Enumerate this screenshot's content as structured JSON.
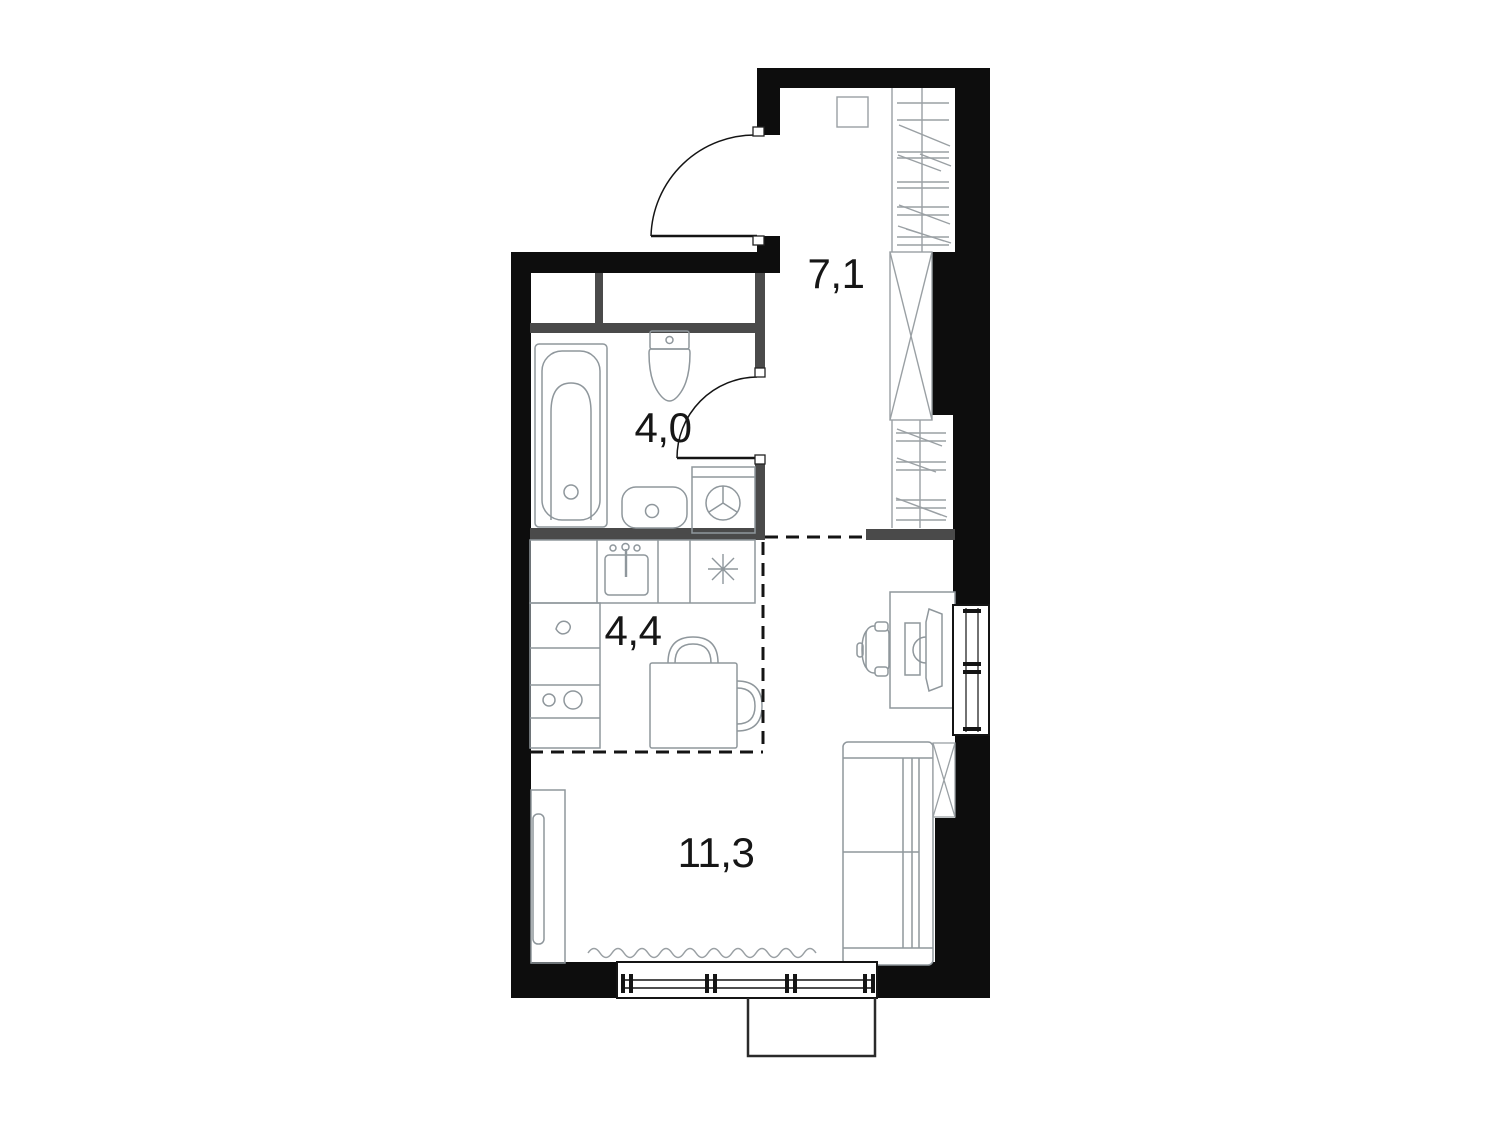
{
  "plan": {
    "type": "apartment-floor-plan",
    "rooms": {
      "hallway": {
        "area_label": "7,1"
      },
      "bathroom": {
        "area_label": "4,0"
      },
      "kitchen": {
        "area_label": "4,4"
      },
      "living_room": {
        "area_label": "11,3"
      }
    },
    "colors": {
      "exterior_wall": "#0d0d0d",
      "partition_wall": "#4a4a4a",
      "fixture_outline": "#8f979c",
      "hatch_line": "#9aa0a4",
      "window_frame": "#141414",
      "label_text": "#161616",
      "background": "#ffffff"
    }
  }
}
